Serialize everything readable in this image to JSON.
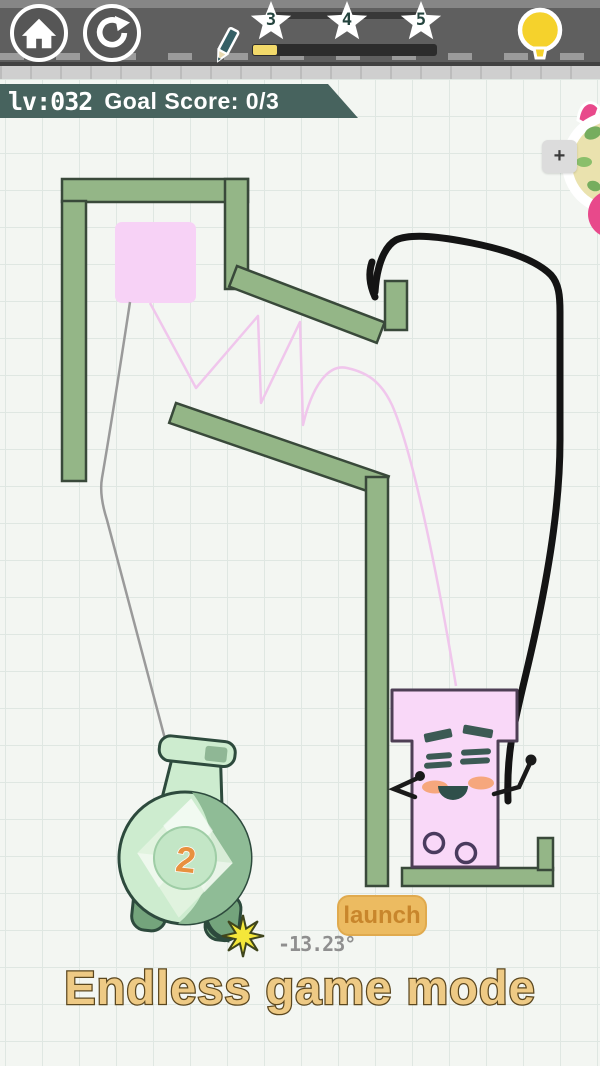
{
  "topbar": {
    "stars": [
      {
        "label": "3"
      },
      {
        "label": "4"
      },
      {
        "label": "5"
      }
    ],
    "progress": {
      "pct": 13
    }
  },
  "hud": {
    "level_label": "lv:032",
    "goal_label": "Goal Score: 0/3",
    "plus_label": "+"
  },
  "game": {
    "bomb_count": "2",
    "launch_label": "launch",
    "angle_label": "-13.23°",
    "mode_label": "Endless game mode"
  },
  "colors": {
    "wall_green": "#94b687",
    "ink_black": "#141414",
    "trajectory_pink": "#f0c6ec",
    "square_pink": "#f7d2f6",
    "character_pink": "#f9d8f8",
    "bomb_green": "#cdeccf",
    "progress_yellow": "#f2d96a",
    "banner_green": "#47635e",
    "launch_orange": "#ecbb61",
    "title_tan": "#eeca85"
  }
}
